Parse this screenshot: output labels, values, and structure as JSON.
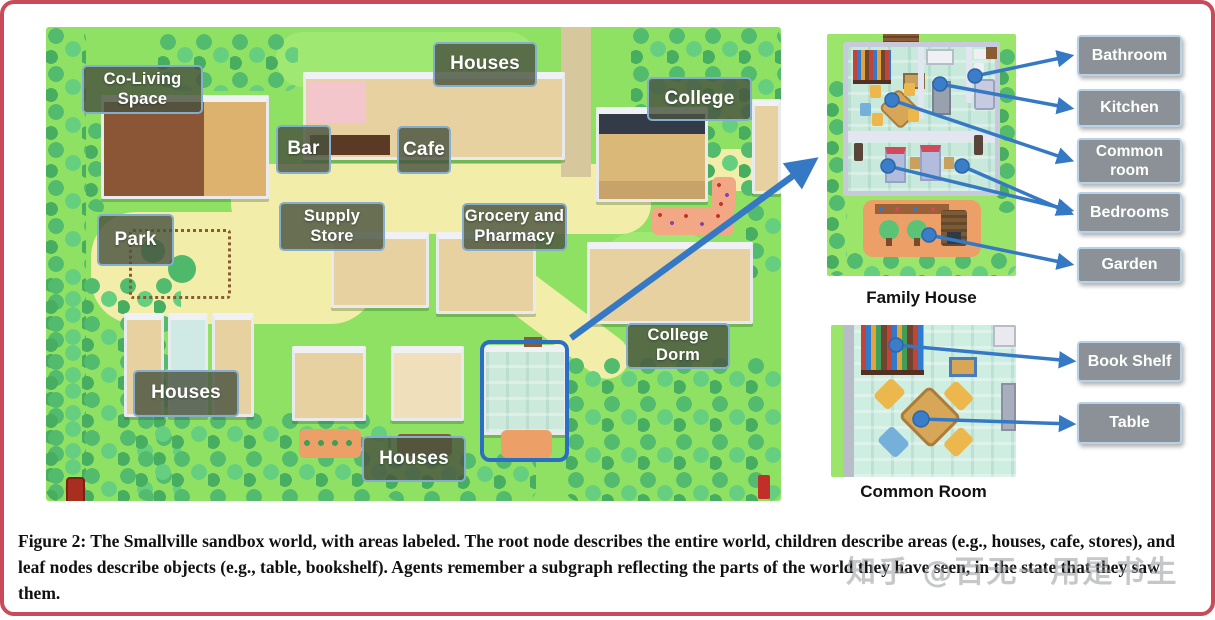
{
  "figure": {
    "caption": "Figure 2: The Smallville sandbox world, with areas labeled. The root node describes the entire world, children describe areas (e.g., houses, cafe, stores), and leaf nodes describe objects (e.g., table, bookshelf). Agents remember a subgraph reflecting the parts of the world they have seen, in the state that they saw them.",
    "watermark": "知乎 @百无一用是书生"
  },
  "map": {
    "name": "Smallville sandbox world",
    "area_labels": [
      {
        "id": "co_living_space",
        "label": "Co-Living Space"
      },
      {
        "id": "houses_top",
        "label": "Houses"
      },
      {
        "id": "college",
        "label": "College"
      },
      {
        "id": "bar",
        "label": "Bar"
      },
      {
        "id": "cafe",
        "label": "Cafe"
      },
      {
        "id": "supply_store",
        "label": "Supply Store"
      },
      {
        "id": "grocery_pharmacy",
        "label": "Grocery and Pharmacy"
      },
      {
        "id": "park",
        "label": "Park"
      },
      {
        "id": "houses_left",
        "label": "Houses"
      },
      {
        "id": "houses_bottom",
        "label": "Houses"
      },
      {
        "id": "college_dorm",
        "label": "College Dorm"
      }
    ]
  },
  "insets": {
    "family_house": {
      "caption": "Family House",
      "labels": [
        "Bathroom",
        "Kitchen",
        "Common room",
        "Bedrooms",
        "Garden"
      ]
    },
    "common_room": {
      "caption": "Common Room",
      "labels": [
        "Book Shelf",
        "Table"
      ]
    }
  },
  "colors": {
    "frame_border": "#c94a58",
    "grass": "#8fe163",
    "path_yellow": "#f2eda8",
    "map_label_bg": "rgba(73,83,64,0.82)",
    "map_label_border": "#84adce",
    "side_label_bg": "#8b9197",
    "side_label_border": "#b5d2e8",
    "arrow_blue": "#3579c4",
    "highlight_blue": "#2b6fc4"
  }
}
